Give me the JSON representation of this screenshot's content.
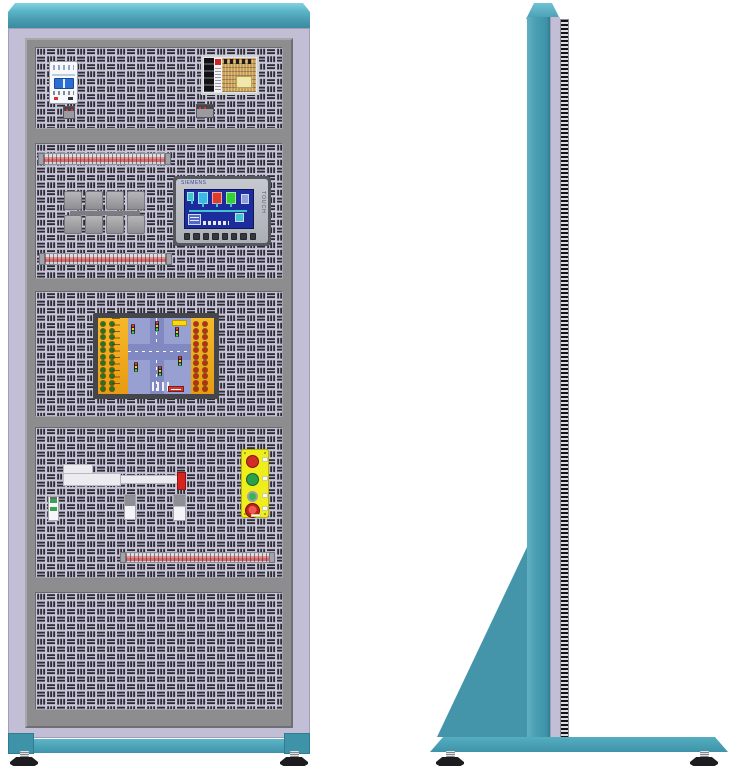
{
  "meta": {
    "subject": "electrical-training-cabinet-elevation-drawing",
    "views": [
      "front",
      "side"
    ]
  },
  "colors": {
    "teal": "#4a9db2",
    "teal_light": "#7fd0dd",
    "teal_dark": "#2f7f92",
    "lavender": "#c2bed6",
    "frame_gray": "#8d8d90",
    "panel_background": "#c8c4d9",
    "slot_dark": "#2c2c33",
    "board_orange": "#f2a71f",
    "board_blue": "#98a0d2",
    "station_yellow": "#f0ed1c",
    "hmi_screen_blue": "#1d2c9c",
    "pcb_tan": "#c99f55",
    "stop_red": "#c4201c",
    "run_green": "#2da04b"
  },
  "front_view": {
    "panel_count": 5,
    "terminal_strip_count": 3,
    "components": {
      "circuit_breaker": "2-pole miniature circuit breaker",
      "power_supply": "open-frame switching power supply",
      "relay_group": "relay block group",
      "hmi": "touch panel HMI",
      "plc_board": "traffic-light trainer I/O board",
      "button_station": "4-element pushbutton station",
      "linear_slide": "linear slide with position sensors"
    }
  },
  "hmi": {
    "brand": "SIEMENS",
    "touch_label": "TOUCH",
    "function_key_count": 8,
    "screen": {
      "background": "#1d2c9c",
      "tank_colors": [
        "#39b9e8",
        "#e03a2c",
        "#35cf3a"
      ]
    }
  },
  "traffic_board": {
    "left_dots": {
      "cols": 2,
      "rows": 11,
      "color": "#157a2e"
    },
    "right_dots": {
      "cols": 2,
      "rows": 11,
      "color": "#c8251f"
    },
    "signal_count": 6
  },
  "button_station": {
    "buttons": [
      "red-pushbutton",
      "green-pushbutton",
      "green-indicator",
      "emergency-stop"
    ]
  },
  "side_view": {
    "support": "triangular gusset with floor base and leveling feet"
  }
}
